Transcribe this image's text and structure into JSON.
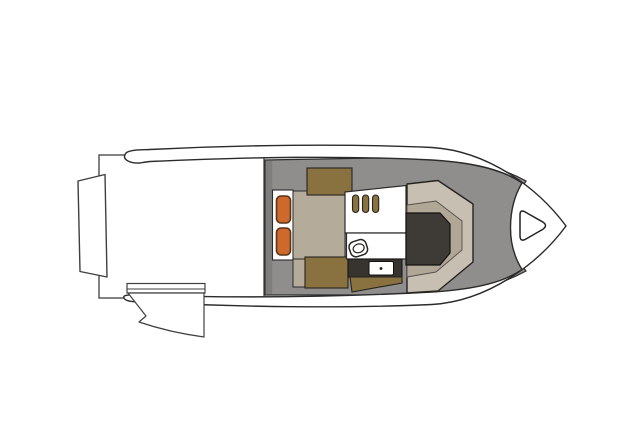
{
  "diagram": {
    "kind": "boat deck floor plan",
    "view": "overhead plan view, bow pointing right"
  },
  "colors": {
    "background": "#ffffff",
    "hull_fill": "#ffffff",
    "hull_outline": "#2b2b2b",
    "gear_outline": "#3f3f3f",
    "deck": "#8f8e8d",
    "deck_shadow": "#7f7e7d",
    "seat_beige": "#b4ab9b",
    "console_beige": "#c7bfb1",
    "console_inner": "#b0a796",
    "table_brown": "#8a7140",
    "cushion_orange": "#cd6a2b",
    "cushion_orange_outline": "#59331a",
    "dark_upholstery": "#3e3a36",
    "appliance_dark": "#37332f",
    "white": "#ffffff"
  },
  "components": {
    "swim_platform": "swim platform",
    "engine_bracket": "transom bracket",
    "outboard_motor": "outboard motor",
    "hull_rim": "hull and gunwale rim",
    "cockpit_deck": "cockpit deck",
    "aft_bench": "aft bench seat",
    "bench_cushions": "two orange bench cushions",
    "lounge_seat": "cockpit lounge seat",
    "cockpit_tables": "two teak cockpit tables",
    "galley_grill": "galley grill grates",
    "galley_sink": "galley sink",
    "galley_stove": "galley stove unit",
    "galley_cabinet": "galley cabinet",
    "bow_console": "forward wraparound seat console",
    "console_cushion": "dark console cushion",
    "anchor_hatch": "bow anchor locker hatch"
  }
}
